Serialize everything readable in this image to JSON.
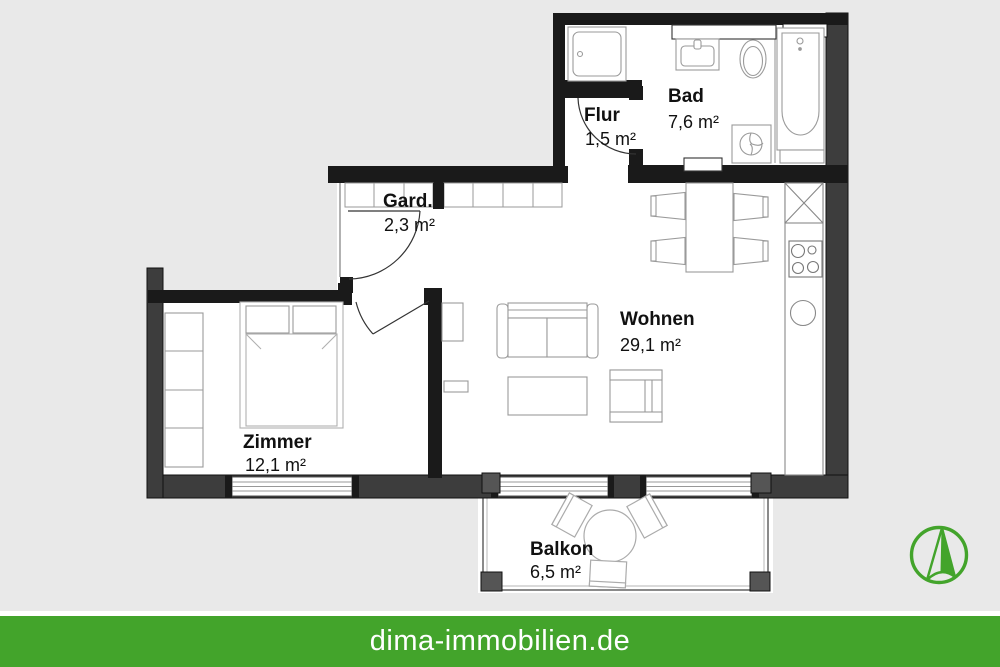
{
  "site": {
    "website": "dima-immobilien.de"
  },
  "colors": {
    "brand_green": "#43a42b",
    "background_gray": "#e9e9e9",
    "wall_black": "#1a1a1a",
    "wall_gray": "#3d3d3d",
    "floor_white": "#ffffff",
    "footer_text": "#ffffff"
  },
  "rooms": [
    {
      "id": "flur",
      "name": "Flur",
      "area": "1,5 m²"
    },
    {
      "id": "bad",
      "name": "Bad",
      "area": "7,6 m²"
    },
    {
      "id": "gard",
      "name": "Gard.",
      "area": "2,3 m²"
    },
    {
      "id": "wohnen",
      "name": "Wohnen",
      "area": "29,1 m²"
    },
    {
      "id": "zimmer",
      "name": "Zimmer",
      "area": "12,1 m²"
    },
    {
      "id": "balkon",
      "name": "Balkon",
      "area": "6,5 m²"
    }
  ],
  "logo": {
    "icon": "compass-north-arrow"
  }
}
